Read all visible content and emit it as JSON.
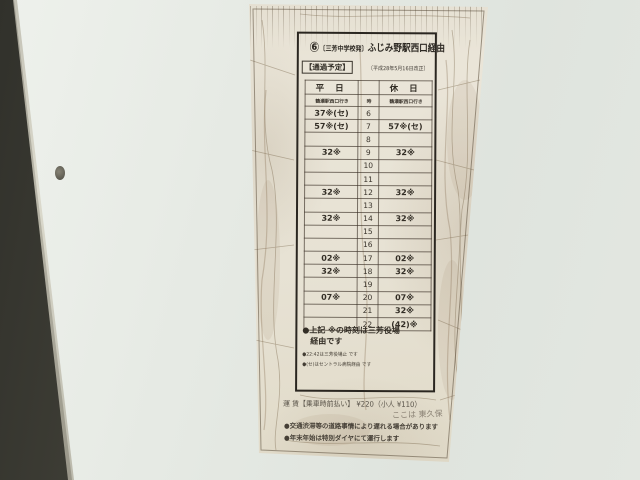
{
  "sign": {
    "route_badge": "⑥",
    "title_bracket": "〔三芳中学校発〕",
    "title_main": "ふじみ野駅西口経由",
    "notice": "【通過予定】",
    "revision": "〔平成28年5月16日改正〕",
    "table": {
      "weekday_header": "平 日",
      "hour_header": "時",
      "holiday_header": "休 日",
      "weekday_destination": "鶴瀬駅西口行き",
      "holiday_destination": "鶴瀬駅西口行き",
      "rows": [
        {
          "hour": "6",
          "weekday": "37※(セ)",
          "holiday": ""
        },
        {
          "hour": "7",
          "weekday": "57※(セ)",
          "holiday": "57※(セ)"
        },
        {
          "hour": "8",
          "weekday": "",
          "holiday": ""
        },
        {
          "hour": "9",
          "weekday": "32※",
          "holiday": "32※"
        },
        {
          "hour": "10",
          "weekday": "",
          "holiday": ""
        },
        {
          "hour": "11",
          "weekday": "",
          "holiday": ""
        },
        {
          "hour": "12",
          "weekday": "32※",
          "holiday": "32※"
        },
        {
          "hour": "13",
          "weekday": "",
          "holiday": ""
        },
        {
          "hour": "14",
          "weekday": "32※",
          "holiday": "32※"
        },
        {
          "hour": "15",
          "weekday": "",
          "holiday": ""
        },
        {
          "hour": "16",
          "weekday": "",
          "holiday": ""
        },
        {
          "hour": "17",
          "weekday": "02※",
          "holiday": "02※"
        },
        {
          "hour": "18",
          "weekday": "32※",
          "holiday": "32※"
        },
        {
          "hour": "19",
          "weekday": "",
          "holiday": ""
        },
        {
          "hour": "20",
          "weekday": "07※",
          "holiday": "07※"
        },
        {
          "hour": "21",
          "weekday": "",
          "holiday": "32※"
        },
        {
          "hour": "22",
          "weekday": "",
          "holiday": "(42)※"
        }
      ]
    },
    "notes": {
      "main_line1": "●上記 ※の時刻は三芳役場",
      "main_line2": "　経由です",
      "small_line1": "●22:42は三芳役場止 です",
      "small_line2": "●(セ)はセントラル病院経由 です"
    },
    "fare": "運 賃【乗車時前払い】 ¥220（小人 ¥110）",
    "handwriting": "ここは 東久保",
    "bottom_note1": "●交通渋滞等の道路事情により遅れる場合があります",
    "bottom_note2": "●年末年始は特別ダイヤにて運行します"
  }
}
